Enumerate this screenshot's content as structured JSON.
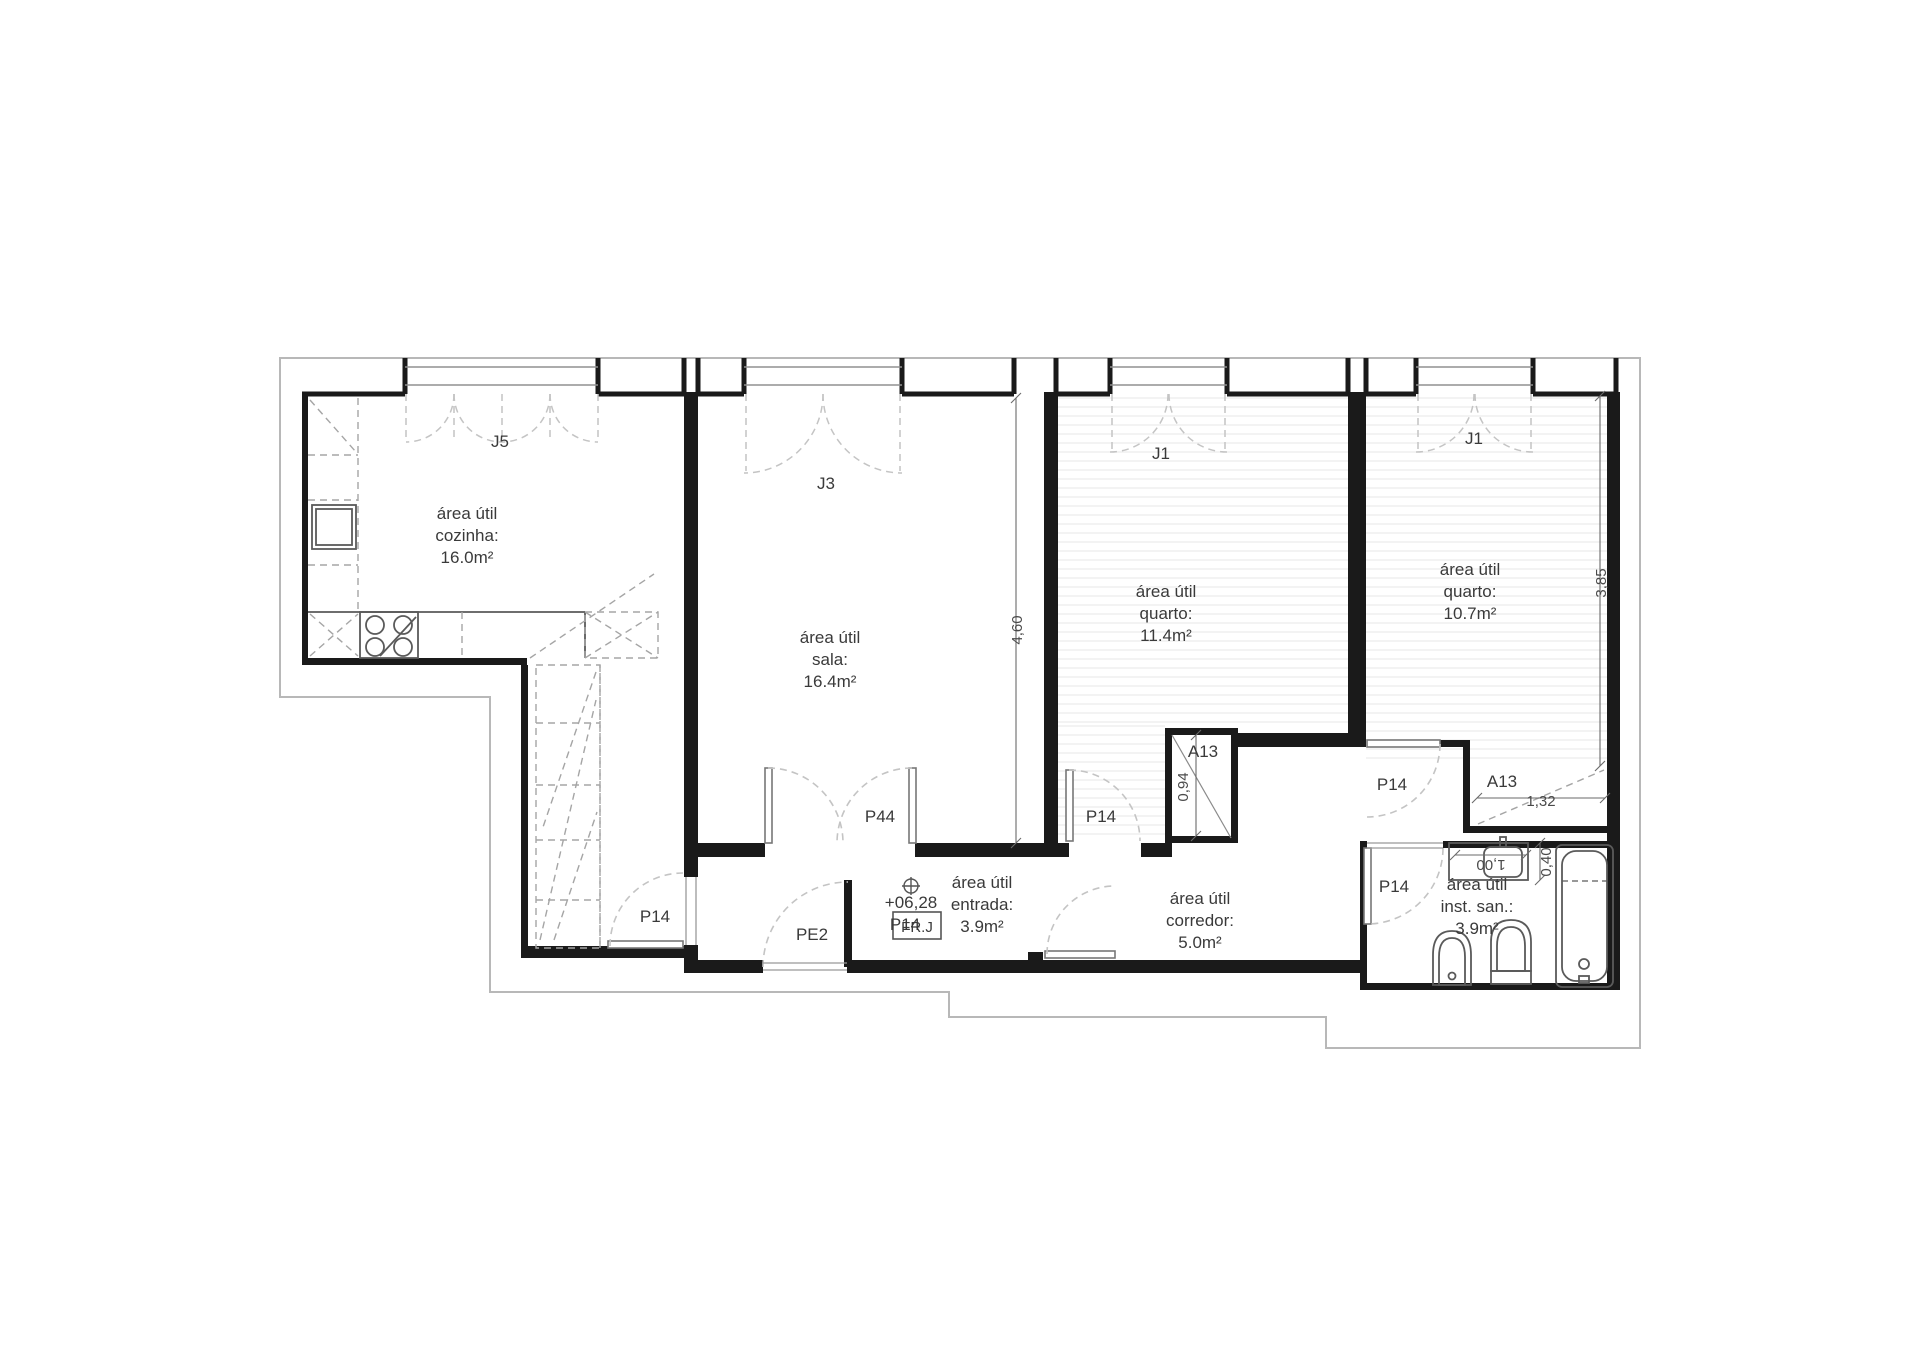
{
  "drawing_title": "apartment floor plan",
  "colors": {
    "wall": "#1a1a1a",
    "outer_boundary": "#b8b8b8",
    "fixture": "#5a5a5a",
    "dashed_furniture": "#a5a5a5",
    "door_swing": "#c4c4c4",
    "dimension": "#6a6a6a",
    "hatch": "#ececec",
    "text": "#3a3a3a"
  },
  "rooms": [
    {
      "id": "cozinha",
      "lines": [
        "área útil",
        "cozinha:",
        "16.0m²"
      ],
      "cx": 467,
      "cy": 519
    },
    {
      "id": "sala",
      "lines": [
        "área útil",
        "sala:",
        "16.4m²"
      ],
      "cx": 830,
      "cy": 643
    },
    {
      "id": "quarto-1",
      "lines": [
        "área útil",
        "quarto:",
        "11.4m²"
      ],
      "cx": 1166,
      "cy": 597
    },
    {
      "id": "quarto-2",
      "lines": [
        "área útil",
        "quarto:",
        "10.7m²"
      ],
      "cx": 1470,
      "cy": 575
    },
    {
      "id": "entrada",
      "lines": [
        "área útil",
        "entrada:",
        "3.9m²"
      ],
      "cx": 982,
      "cy": 888
    },
    {
      "id": "corredor",
      "lines": [
        "área útil",
        "corredor:",
        "5.0m²"
      ],
      "cx": 1200,
      "cy": 904
    },
    {
      "id": "inst-san",
      "lines": [
        "área útil",
        "inst. san.:",
        "3.9m²"
      ],
      "cx": 1477,
      "cy": 890
    }
  ],
  "window_tags": [
    {
      "label": "J5",
      "x": 500,
      "y": 447
    },
    {
      "label": "J3",
      "x": 826,
      "y": 489
    },
    {
      "label": "J1",
      "x": 1161,
      "y": 459
    },
    {
      "label": "J1",
      "x": 1474,
      "y": 444
    }
  ],
  "door_tags": [
    {
      "label": "P14",
      "x": 655,
      "y": 922
    },
    {
      "label": "P14",
      "x": 905,
      "y": 930
    },
    {
      "label": "P14",
      "x": 1101,
      "y": 822
    },
    {
      "label": "P14",
      "x": 1392,
      "y": 790
    },
    {
      "label": "P14",
      "x": 1394,
      "y": 892
    },
    {
      "label": "P44",
      "x": 880,
      "y": 822
    },
    {
      "label": "PE2",
      "x": 812,
      "y": 940
    }
  ],
  "closet_tags": [
    {
      "label": "A13",
      "x": 1203,
      "y": 757
    },
    {
      "label": "A13",
      "x": 1502,
      "y": 787
    }
  ],
  "dimensions": [
    {
      "label": "4,60",
      "x": 1022,
      "y": 630,
      "rot": -90
    },
    {
      "label": "3,85",
      "x": 1606,
      "y": 583,
      "rot": -90
    },
    {
      "label": "0,94",
      "x": 1188,
      "y": 787,
      "rot": -90
    },
    {
      "label": "1,32",
      "x": 1541,
      "y": 806,
      "rot": 0
    },
    {
      "label": "1,00",
      "x": 1491,
      "y": 860,
      "rot": 180
    },
    {
      "label": "0,40",
      "x": 1551,
      "y": 862,
      "rot": -90
    }
  ],
  "level_marker": {
    "label": "+06,28",
    "x": 911,
    "y": 908
  },
  "fridge_box": {
    "label": "FR.J",
    "x": 917,
    "y": 932
  }
}
